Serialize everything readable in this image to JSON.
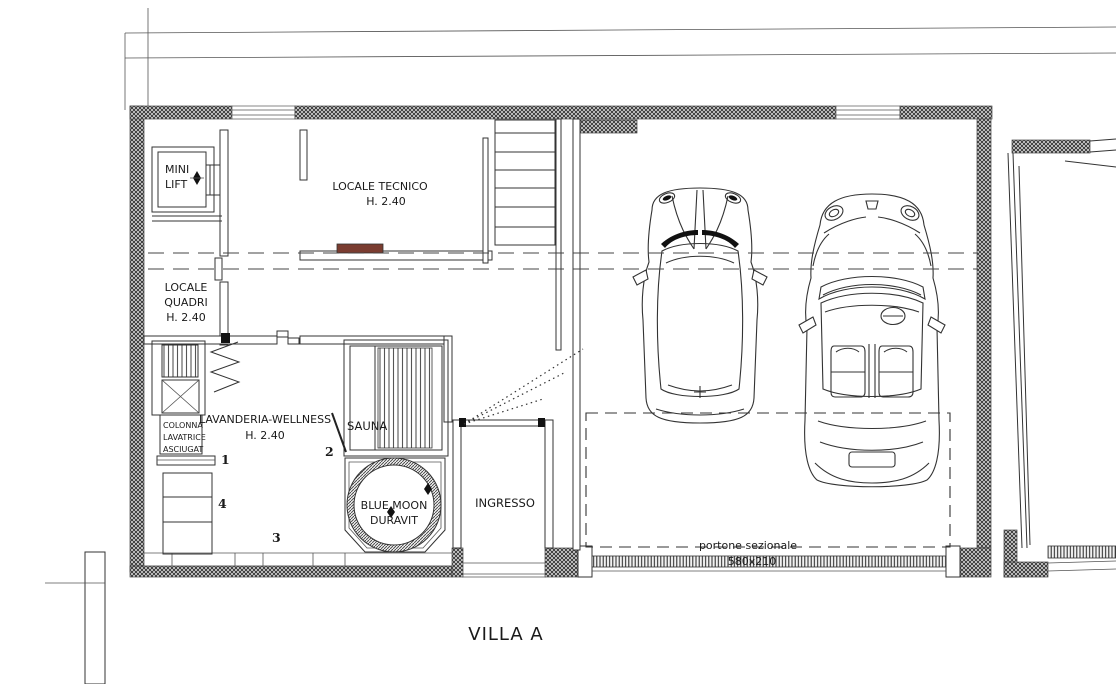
{
  "page": {
    "title": "VILLA A"
  },
  "colors": {
    "annotation_red": "#b34141",
    "heater_brown": "#7a3c30",
    "line_dark": "#333333"
  },
  "rooms": {
    "mini_lift": {
      "line1": "MINI",
      "line2": "LIFT"
    },
    "locale_tecnico": {
      "name": "LOCALE TECNICO",
      "height": "H. 2.40"
    },
    "locale_quadri": {
      "line1": "LOCALE",
      "line2": "QUADRI",
      "height": "H. 2.40"
    },
    "lavanderia_wellness": {
      "name": "LAVANDERIA-WELLNESS",
      "height": "H. 2.40"
    },
    "sauna": {
      "name": "SAUNA"
    },
    "ingresso": {
      "name": "INGRESSO"
    }
  },
  "fixtures": {
    "colonna_lavatrice": {
      "line1": "COLONNA",
      "line2": "LAVATRICE",
      "line3": "ASCIUGAT"
    },
    "bathtub": {
      "line1": "BLUE MOON",
      "line2": "DURAVIT"
    }
  },
  "garage": {
    "door_label": "portone sezionale",
    "door_dimension": "580x210"
  },
  "annotations": {
    "num1": "1",
    "num2": "2",
    "num3": "3",
    "num4": "4"
  }
}
